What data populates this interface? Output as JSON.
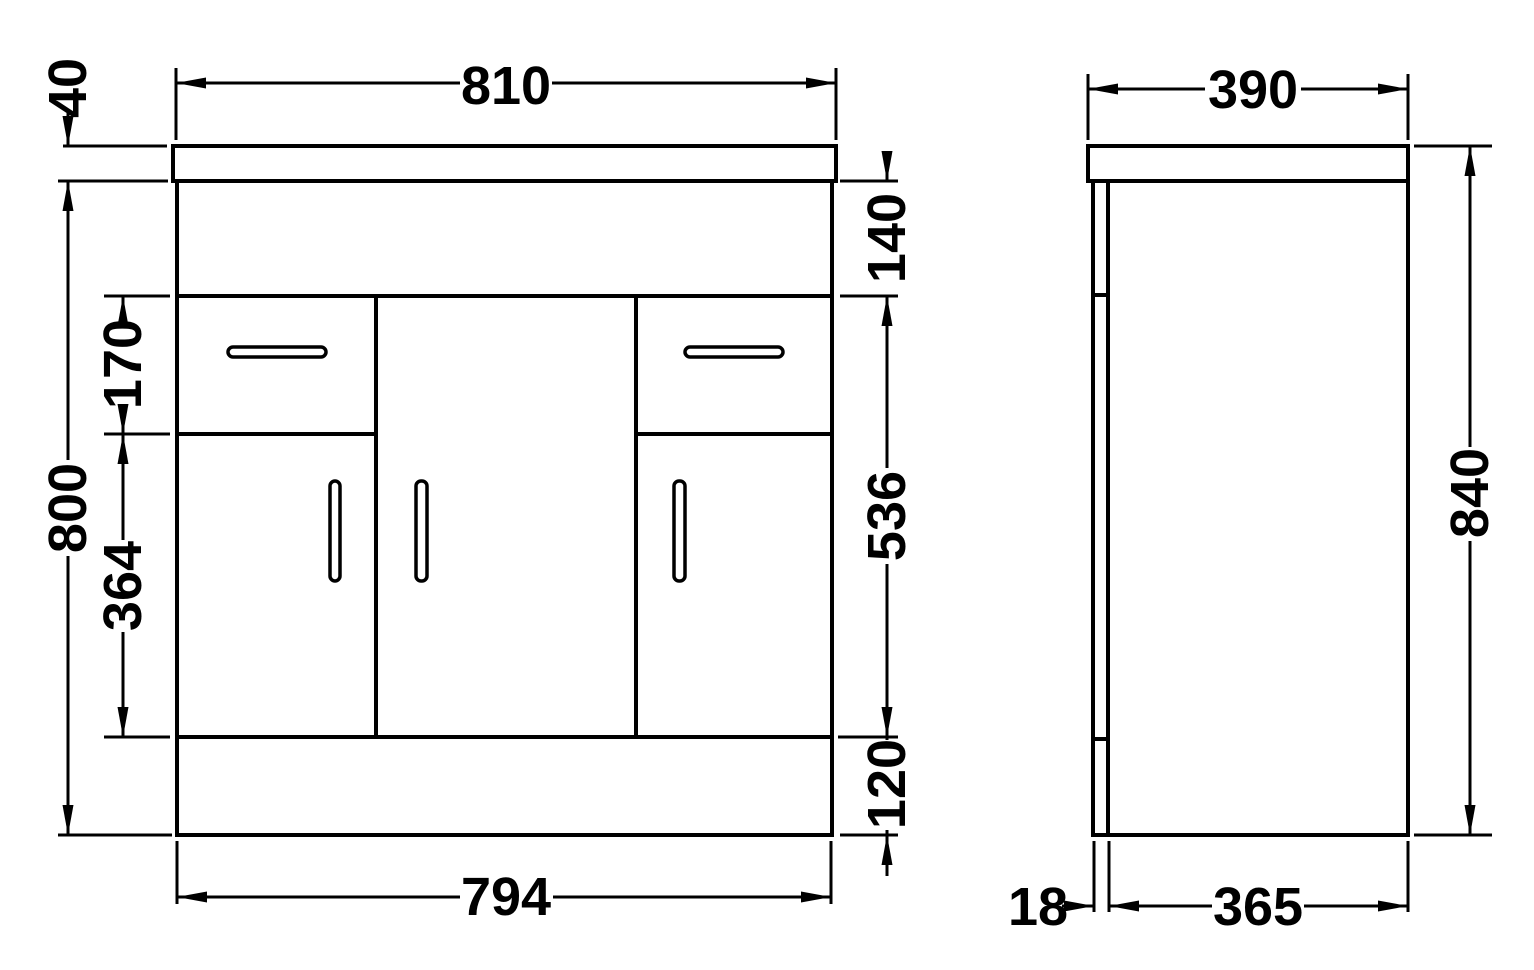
{
  "dims": {
    "front": {
      "worktop_thickness": "40",
      "worktop_width": "810",
      "top_band_height": "140",
      "drawer_front_height": "170",
      "door_front_height": "364",
      "cabinet_height": "800",
      "door_region_height": "536",
      "plinth_height": "120",
      "cabinet_width": "794"
    },
    "side": {
      "overall_depth": "390",
      "overall_height": "840",
      "door_front_thickness": "18",
      "carcass_depth": "365"
    }
  },
  "colors": {
    "line": "#000000",
    "background": "#ffffff"
  }
}
